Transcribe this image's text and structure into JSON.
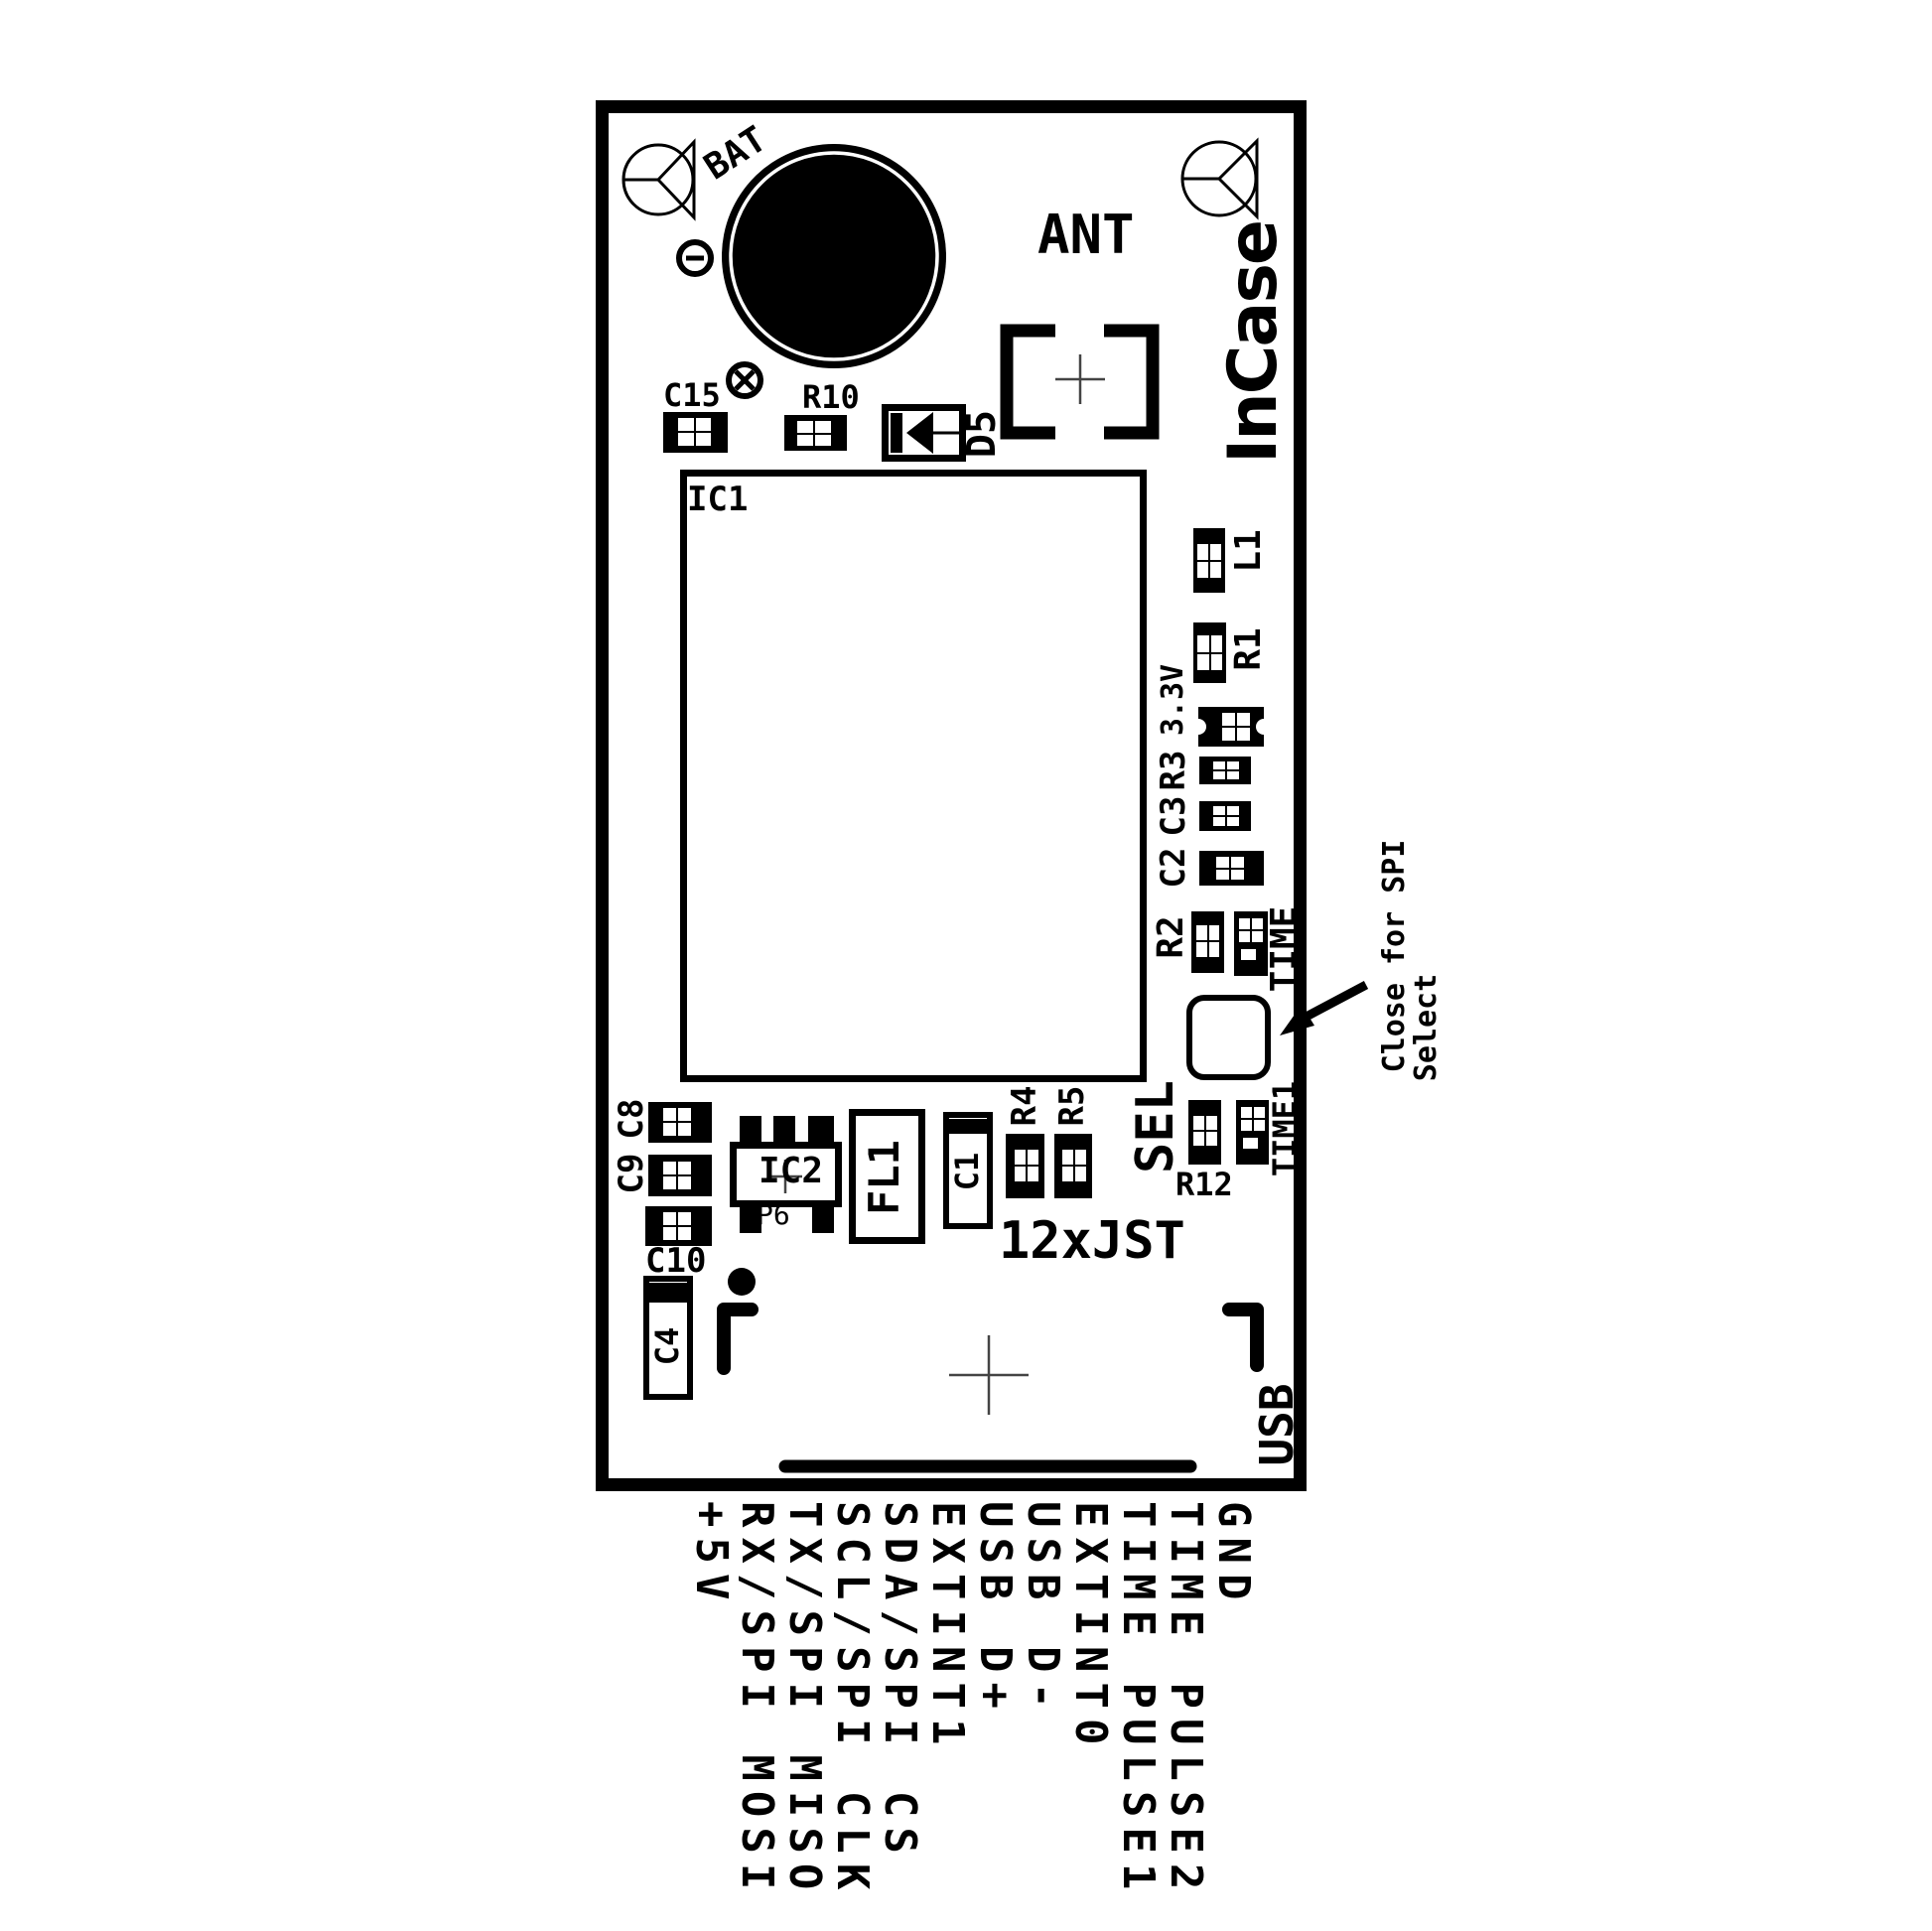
{
  "board": {
    "refs": {
      "ic1": "IC1",
      "ic2": "IC2",
      "p6": "P6",
      "fl1": "FL1",
      "c1": "C1",
      "c2": "C2",
      "c3": "C3",
      "c4": "C4",
      "c8": "C8",
      "c9": "C9",
      "c10": "C10",
      "c15": "C15",
      "r1": "R1",
      "r2": "R2",
      "r3": "R3",
      "r4": "R4",
      "r5": "R5",
      "r10": "R10",
      "r12": "R12",
      "l1": "L1",
      "d5": "D5"
    },
    "labels": {
      "bat": "BAT",
      "ant": "ANT",
      "brand": "InCase",
      "usb": "USB",
      "sel": "SEL",
      "time": "TIME",
      "time1": "TIME1",
      "rail": "3.3V",
      "connector": "12xJST"
    }
  },
  "annotation": {
    "line1": "Close for SPI",
    "line2": "Select"
  },
  "pins": [
    "+5V",
    "RX/SPI MOSI",
    "TX/SPI MISO",
    "SCL/SPI CLK",
    "SDA/SPI CS",
    "EXTINT1",
    "USB D+",
    "USB D-",
    "EXTINT0",
    "TIME PULSE1",
    "TIME PULSE2",
    "GND"
  ],
  "colors": {
    "silkscreen": "#000000",
    "background": "#ffffff"
  }
}
